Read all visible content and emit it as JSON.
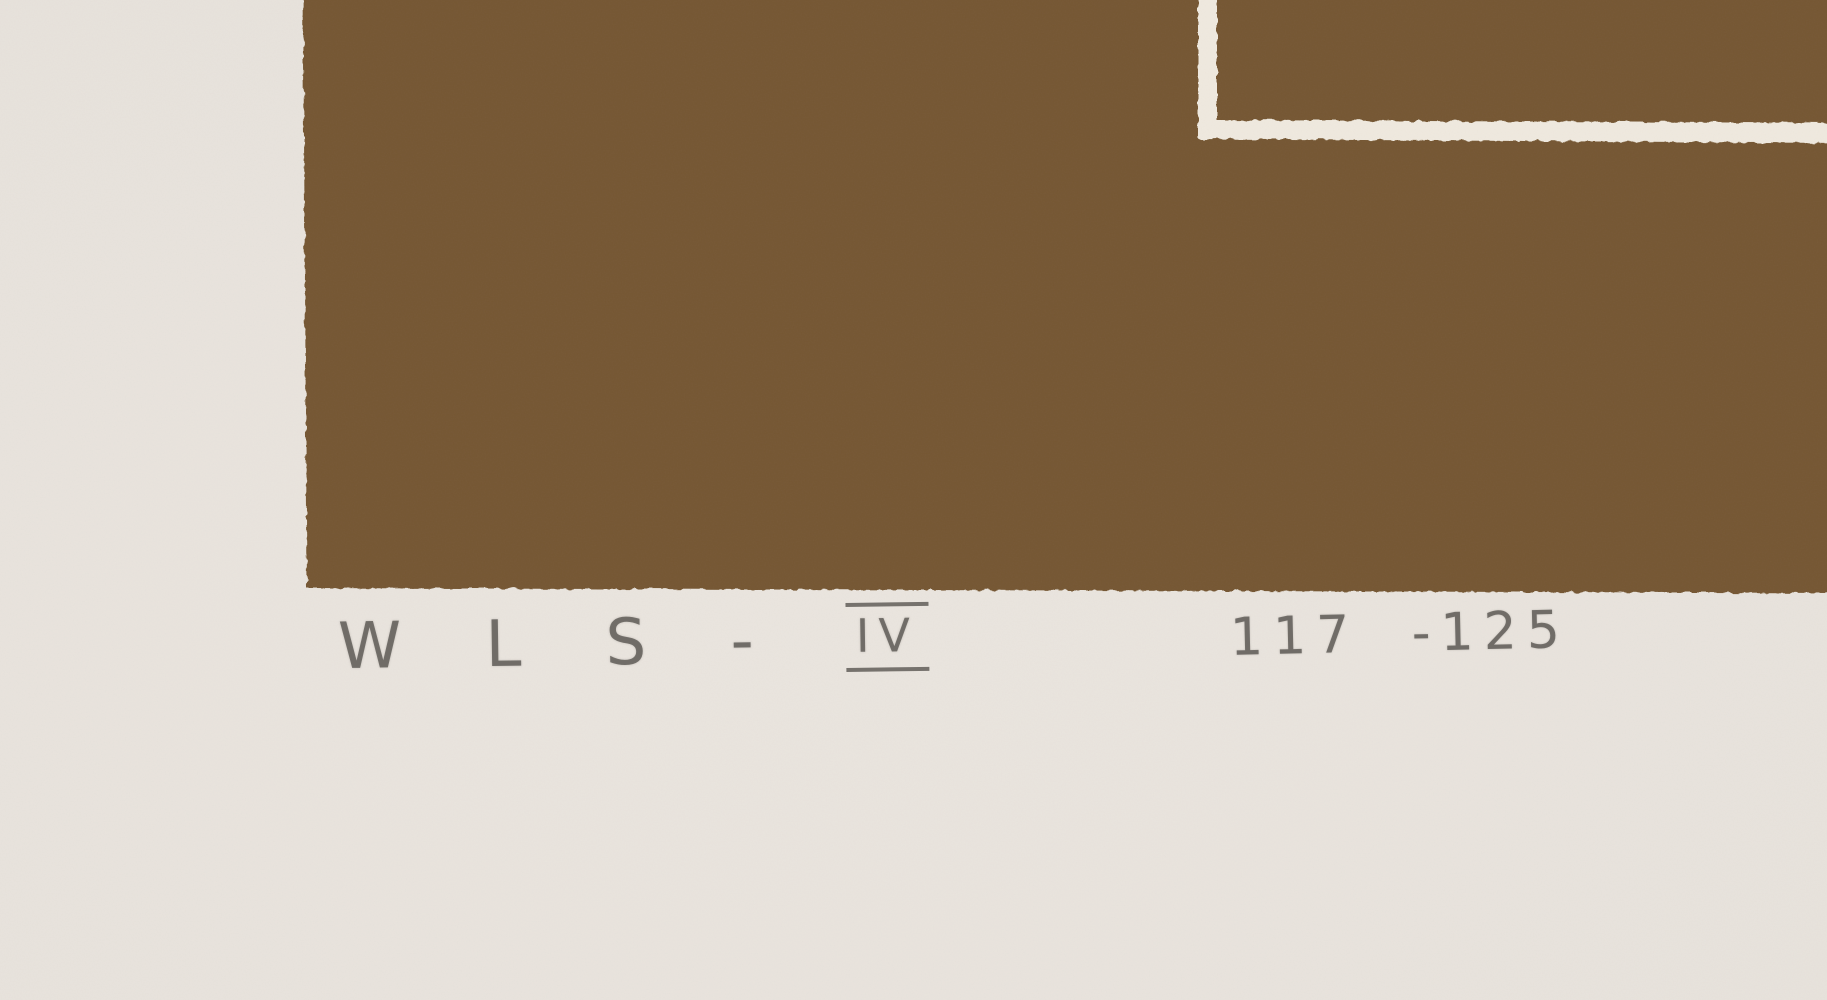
{
  "artwork": {
    "inscriptions": {
      "signature_prefix": "W L S -",
      "signature_numeral": "IV",
      "edition": "117 -125"
    },
    "colors": {
      "paper": "#e8e3dc",
      "print_brown": "#745733",
      "line_white": "#f0eadf",
      "pencil_gray": "rgba(97,94,89,0.85)"
    }
  }
}
